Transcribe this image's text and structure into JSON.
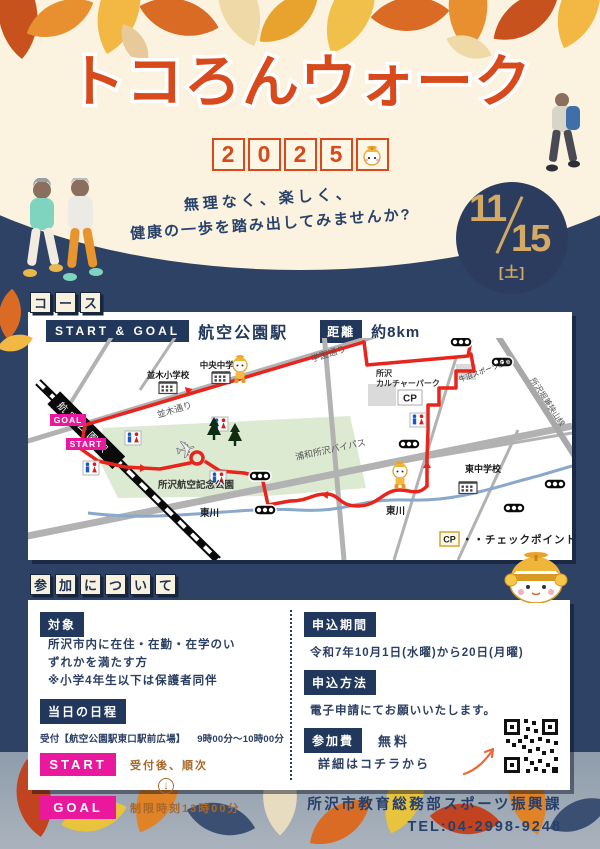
{
  "poster": {
    "title": "トコろんウォーク",
    "year_digits": [
      "2",
      "0",
      "2",
      "5"
    ],
    "tagline_line1": "無理なく、楽しく、",
    "tagline_line2": "健康の一歩を踏み出してみませんか?",
    "date": {
      "month": "11",
      "day": "15",
      "weekday": "[土]"
    }
  },
  "course": {
    "label_chars": [
      "コ",
      "ー",
      "ス"
    ],
    "start_goal_label": "START & GOAL",
    "station": "航空公園駅",
    "distance_label": "距離",
    "distance_value": "約8km",
    "map": {
      "labels": {
        "namiki_elementary": "並木小学校",
        "chuo_junior_high": "中央中学校",
        "namiki_street": "並木通り",
        "gakuen_street": "学園通り",
        "culture_park_line1": "所沢",
        "culture_park_line2": "カルチャーパーク",
        "cp": "CP",
        "ushinuma_sports": "牛沼スポーツ広場",
        "horigane_sayama_line": "所沢堀兼狭山線",
        "higashi_junior_high": "東中学校",
        "higashigawa_left": "東川",
        "higashigawa_right": "東川",
        "urawa_tokorozawa_bypass": "浦和所沢バイパス",
        "aviation_park": "所沢航空記念公園",
        "station_on_rail": "航空公園駅",
        "goal": "GOAL",
        "start": "START"
      },
      "legend": {
        "cp_box": "CP",
        "cp_text": "・・チェックポイント"
      }
    }
  },
  "participation": {
    "label_chars": [
      "参",
      "加",
      "に",
      "つ",
      "い",
      "て"
    ],
    "target": {
      "label": "対象",
      "body": "所沢市内に在住・在勤・在学のいずれかを満たす方",
      "note": "※小学4年生以下は保護者同伴"
    },
    "schedule": {
      "label": "当日の日程",
      "reception": "受付【航空公園駅東口駅前広場】",
      "reception_time": "9時00分～10時00分",
      "start_label": "START",
      "start_note": "受付後、順次",
      "down_arrow": "↓",
      "goal_label": "GOAL",
      "goal_note": "制限時刻13時00分"
    },
    "period": {
      "label": "申込期間",
      "value": "令和7年10月1日(水曜)から20日(月曜)"
    },
    "method": {
      "label": "申込方法",
      "value": "電子申請にてお願いいたします。"
    },
    "fee": {
      "label": "参加費",
      "value": "無料"
    },
    "qr_note": "詳細はコチラから"
  },
  "footer": {
    "org": "所沢市教育総務部スポーツ振興課",
    "tel": "TEL:04-2998-9248"
  },
  "colors": {
    "navy": "#2e4266",
    "cream": "#fbf3df",
    "title_orange": "#d8491b",
    "date_tan": "#d3a964",
    "magenta": "#ea189d",
    "route_red": "#e8251d",
    "park_green": "#dcead2",
    "note_brown": "#a8682a"
  }
}
